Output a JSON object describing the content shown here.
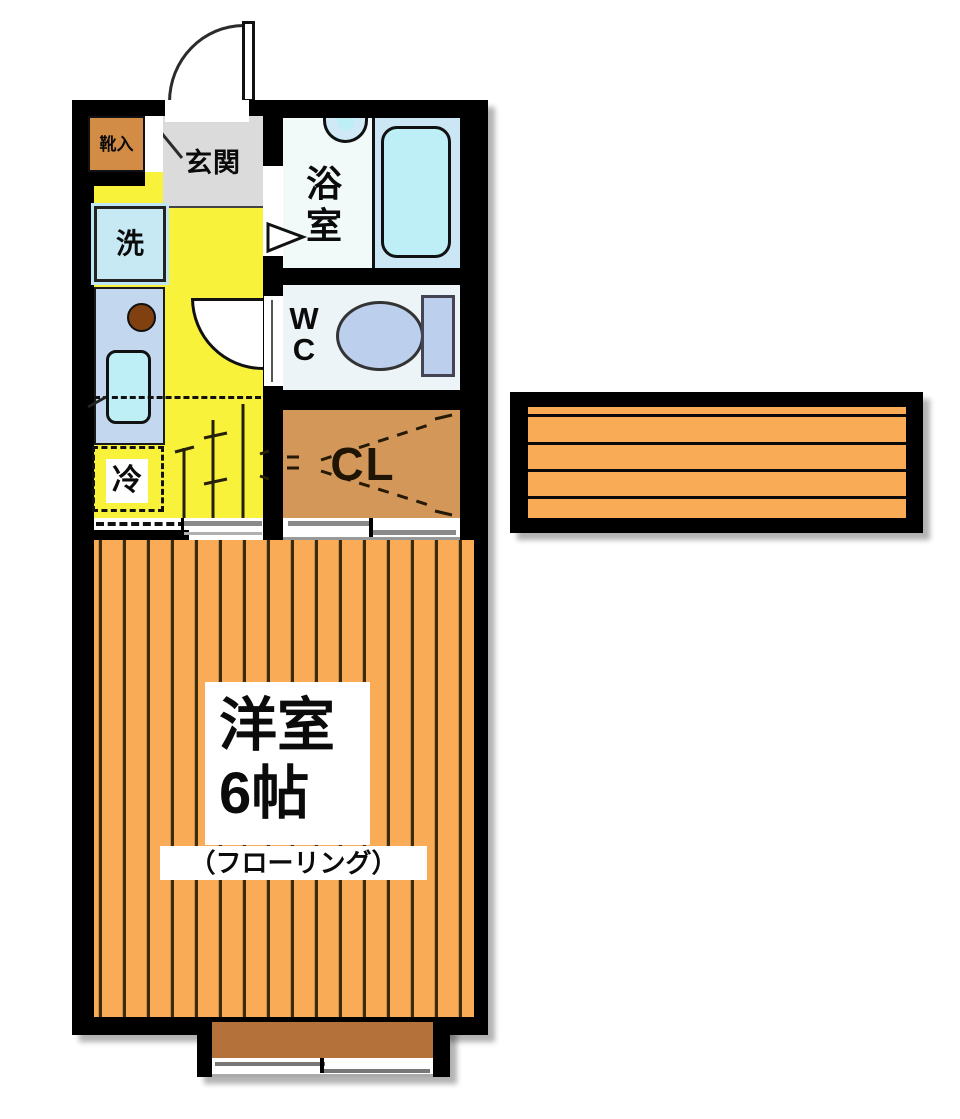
{
  "title": "1K apartment floor plan",
  "labels": {
    "entrance": "玄関",
    "shoe_box": "靴入",
    "washer": "洗",
    "bathroom": [
      "浴",
      "室"
    ],
    "wc": [
      "W",
      "C"
    ],
    "closet": "CL",
    "fridge": "冷",
    "room_name": "洋室",
    "room_size": "6帖",
    "room_note": "（フローリング）"
  },
  "colors": {
    "wall": "#000000",
    "hall_floor": "#F8F23B",
    "entrance_floor": "#DBDBDB",
    "room_floor": "#F9AC55",
    "closet_floor": "#D3975A",
    "bath_fixture": "#BEEFF7",
    "bath_panel": "#CBE6F5",
    "kitchen_counter": "#C3D8EE",
    "washer_box": "#C6E9F4",
    "toilet": "#BCCFEC",
    "bay_platform": "#B5713A",
    "shoe_cabinet": "#D38C45",
    "burner": "#81400F"
  }
}
